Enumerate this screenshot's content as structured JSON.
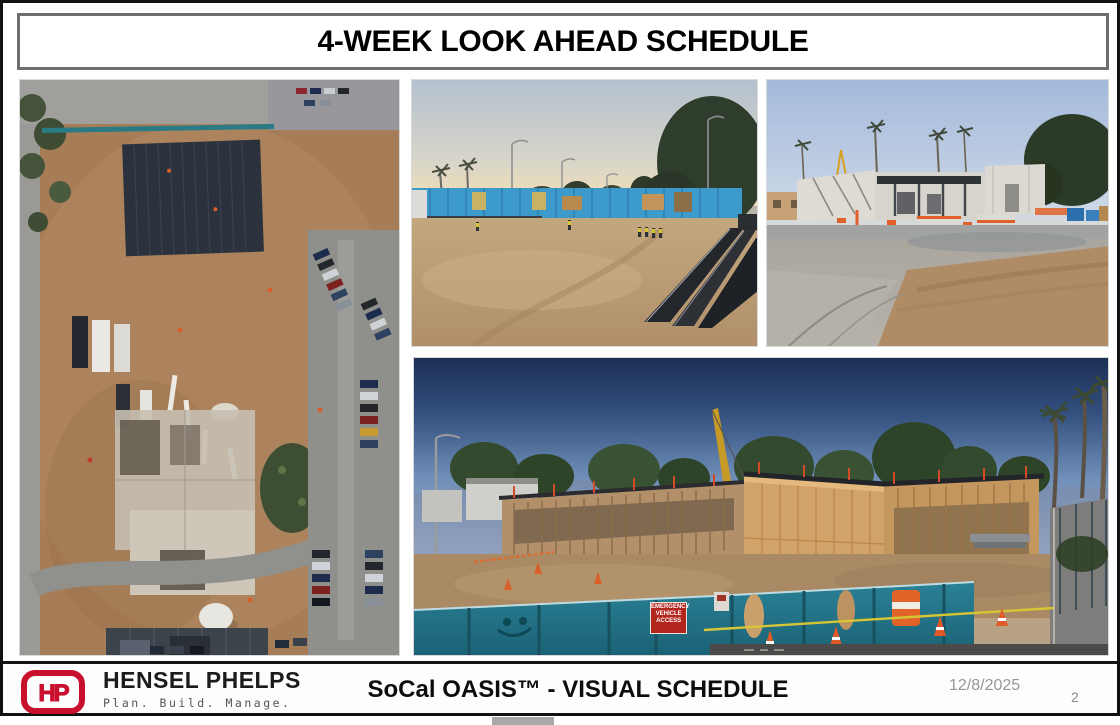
{
  "slide": {
    "title": "4-WEEK LOOK AHEAD SCHEDULE",
    "fence_sign": "EMERGENCY\nVEHICLE\nACCESS",
    "footer": {
      "monogram": "HP",
      "company": "HENSEL PHELPS",
      "tagline": "Plan. Build. Manage.",
      "caption": "SoCal OASIS™ - VISUAL SCHEDULE",
      "date": "12/8/2025",
      "page": "2"
    },
    "colors": {
      "brand_red": "#C8102E",
      "date_gray": "#969696"
    }
  }
}
